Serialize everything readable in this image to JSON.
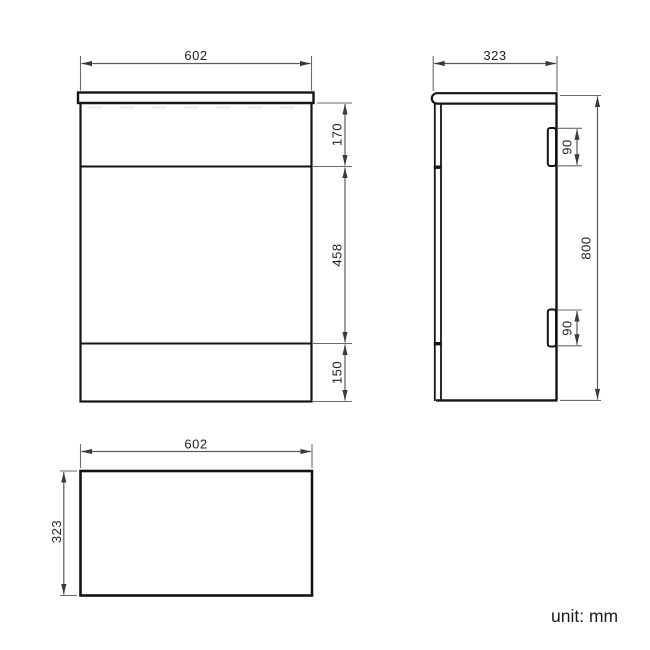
{
  "drawing": {
    "unit_note": "unit: mm",
    "line_color": "#141414",
    "dim_color": "#5a5a5a",
    "views": {
      "front": {
        "title": "front-elevation",
        "overall_width": "602",
        "top_section_height": "170",
        "middle_section_height": "458",
        "bottom_section_height": "150"
      },
      "side": {
        "title": "side-elevation",
        "overall_depth": "323",
        "overall_height": "800",
        "top_hinge_height": "90",
        "bottom_hinge_height": "90"
      },
      "plan": {
        "title": "plan-view",
        "overall_width": "602",
        "overall_depth": "323"
      }
    }
  }
}
